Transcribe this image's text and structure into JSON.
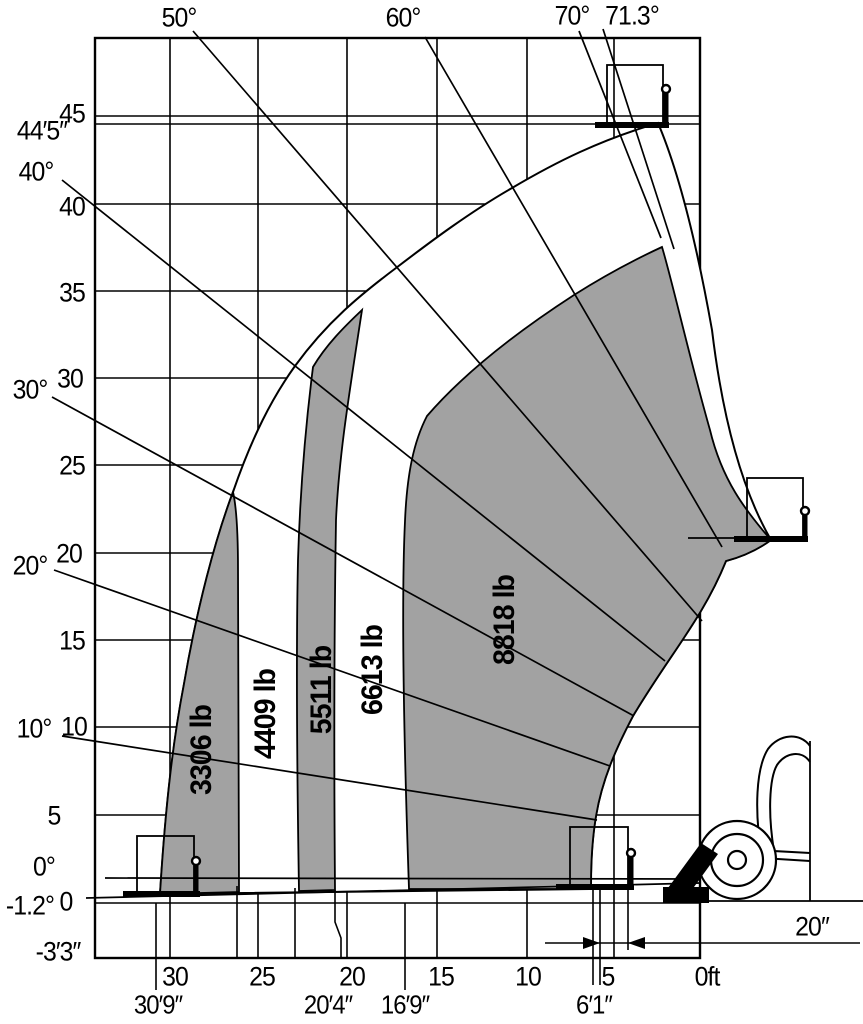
{
  "chart_data": {
    "type": "area",
    "subtype": "telehandler-load-capacity-envelope",
    "title": "",
    "units": {
      "reach": "ft",
      "height": "ft",
      "capacity": "lb",
      "boom_angle": "deg"
    },
    "x_axis": {
      "label": "0ft",
      "direction": "reach increases right-to-left, origin at machine front",
      "ticks_ft": [
        30,
        25,
        20,
        15,
        10,
        5,
        0
      ],
      "reach_marks": [
        "30′9″",
        "20′4″",
        "16′9″",
        "6′1″"
      ]
    },
    "y_axis": {
      "ticks_ft": [
        45,
        40,
        35,
        30,
        25,
        20,
        15,
        10,
        5,
        0
      ],
      "max_lift_height_mark": "44′5″",
      "below_grade_mark": "-3′3″"
    },
    "boom_angle_lines_deg": [
      -1.2,
      0,
      10,
      20,
      30,
      40,
      50,
      60,
      70,
      71.3
    ],
    "capacity_zones": [
      {
        "capacity_lb": 3306,
        "label": "3306 lb",
        "outer_reach_mark": "30′9″",
        "fill": "gray"
      },
      {
        "capacity_lb": 4409,
        "label": "4409 lb",
        "fill": "white"
      },
      {
        "capacity_lb": 5511,
        "label": "5511 lb",
        "outer_reach_mark": "20′4″",
        "fill": "gray"
      },
      {
        "capacity_lb": 6613,
        "label": "6613 lb",
        "outer_reach_mark": "16′9″",
        "fill": "white"
      },
      {
        "capacity_lb": 8818,
        "label": "8818 lb",
        "outer_reach_mark": "6′1″",
        "fill": "gray"
      }
    ],
    "frame_to_fork_dimension": "20″",
    "colors": {
      "zone_gray": "#a2a2a2",
      "line": "#000000",
      "background": "#ffffff"
    },
    "grid": "on",
    "icons": [
      "fork-load-top",
      "fork-load-right",
      "fork-load-bottom-center",
      "fork-load-bottom-left",
      "machine-wheel",
      "machine-fender",
      "boom-stub"
    ]
  },
  "labels": {
    "groups": [
      {
        "name": "boom-angle-label",
        "cls": "ax",
        "items": [
          {
            "text": "50°",
            "x": 179,
            "y": 18
          },
          {
            "text": "60°",
            "x": 403,
            "y": 18
          },
          {
            "text": "70°",
            "x": 572,
            "y": 16
          },
          {
            "text": "71.3°",
            "x": 632,
            "y": 16
          }
        ]
      },
      {
        "name": "y-axis-label",
        "cls": "ax",
        "items": [
          {
            "text": "45",
            "x": 72,
            "y": 114
          },
          {
            "text": "44′5″",
            "x": 42,
            "y": 131
          },
          {
            "text": "40°",
            "x": 36,
            "y": 172
          },
          {
            "text": "40",
            "x": 72,
            "y": 207
          },
          {
            "text": "35",
            "x": 72,
            "y": 293
          },
          {
            "text": "30°",
            "x": 30,
            "y": 390
          },
          {
            "text": "30",
            "x": 70,
            "y": 379
          },
          {
            "text": "25",
            "x": 72,
            "y": 466
          },
          {
            "text": "20°",
            "x": 30,
            "y": 566
          },
          {
            "text": "20",
            "x": 69,
            "y": 554
          },
          {
            "text": "15",
            "x": 72,
            "y": 641
          },
          {
            "text": "10°",
            "x": 34,
            "y": 729
          },
          {
            "text": "10",
            "x": 74,
            "y": 727
          },
          {
            "text": "5",
            "x": 54,
            "y": 816
          },
          {
            "text": "0°",
            "x": 44,
            "y": 867
          },
          {
            "text": "-1.2°",
            "x": 30,
            "y": 906
          },
          {
            "text": "0",
            "x": 66,
            "y": 902
          },
          {
            "text": "-3′3″",
            "x": 58,
            "y": 952
          }
        ]
      },
      {
        "name": "x-axis-label",
        "cls": "ax",
        "items": [
          {
            "text": "30",
            "x": 175,
            "y": 977
          },
          {
            "text": "25",
            "x": 262,
            "y": 977
          },
          {
            "text": "20",
            "x": 352,
            "y": 977
          },
          {
            "text": "15",
            "x": 441,
            "y": 977
          },
          {
            "text": "10",
            "x": 528,
            "y": 977
          },
          {
            "text": "5",
            "x": 608,
            "y": 977
          },
          {
            "text": "0ft",
            "x": 707,
            "y": 977
          }
        ]
      },
      {
        "name": "reach-mark-label",
        "cls": "ax2",
        "items": [
          {
            "text": "30′9″",
            "x": 158,
            "y": 1005
          },
          {
            "text": "20′4″",
            "x": 328,
            "y": 1005
          },
          {
            "text": "16′9″",
            "x": 405,
            "y": 1005
          },
          {
            "text": "6′1″",
            "x": 594,
            "y": 1005
          }
        ]
      },
      {
        "name": "dimension-label",
        "cls": "ax",
        "items": [
          {
            "text": "20″",
            "x": 812,
            "y": 927
          }
        ]
      },
      {
        "name": "capacity-zone-label",
        "cls": "zone",
        "items": [
          {
            "text": "3306 lb",
            "x": 202,
            "y": 750
          },
          {
            "text": "4409 lb",
            "x": 266,
            "y": 714
          },
          {
            "text": "5511 lb",
            "x": 322,
            "y": 690
          },
          {
            "text": "6613 lb",
            "x": 373,
            "y": 670
          },
          {
            "text": "8818 lb",
            "x": 505,
            "y": 620
          }
        ]
      }
    ]
  }
}
